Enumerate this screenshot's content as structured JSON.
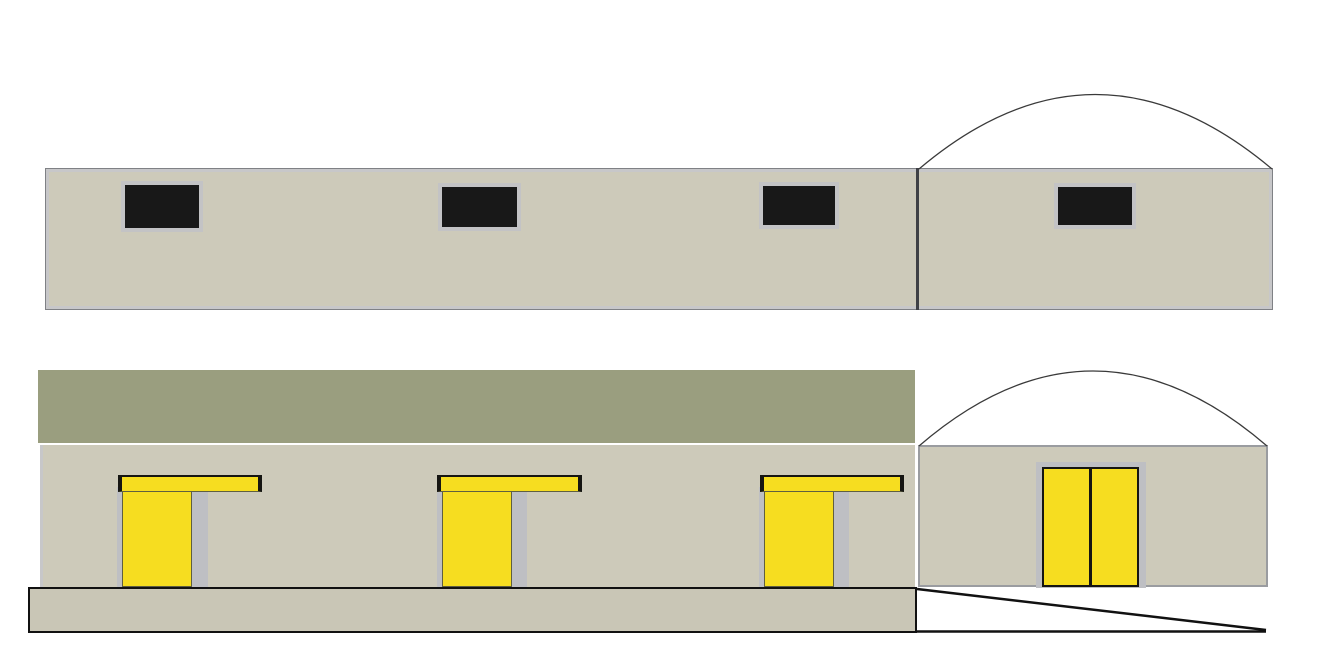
{
  "colors": {
    "background": "#ffffff",
    "wall": "#cdcaba",
    "wall_outline": "#7f8185",
    "wall_outline2": "#9a9ca0",
    "inner_frame": "#c7c7c9",
    "divider": "#3f4146",
    "olive_band": "#9a9e7f",
    "window_fill": "#181818",
    "window_frame": "#c3c3c5",
    "yellow": "#f6dd20",
    "door_border": "#5f5f40",
    "canopy_cap": "#151512",
    "recess": "#bebfc3",
    "plinth": "#c9c6b6",
    "line": "#111111",
    "arc": "#3a3a3a"
  },
  "scene": {
    "views": [
      {
        "name": "upper-elevation",
        "components": [
          "long-wall",
          "section-divider",
          "dome-roof-arc",
          "window-1",
          "window-2",
          "window-3",
          "window-4"
        ]
      },
      {
        "name": "lower-elevation",
        "components": [
          "olive-roof-band",
          "long-wall",
          "door-unit-1",
          "door-unit-2",
          "door-unit-3",
          "dome-section-wall",
          "dome-roof-arc",
          "double-door",
          "base-plinth",
          "ramp"
        ]
      }
    ]
  }
}
